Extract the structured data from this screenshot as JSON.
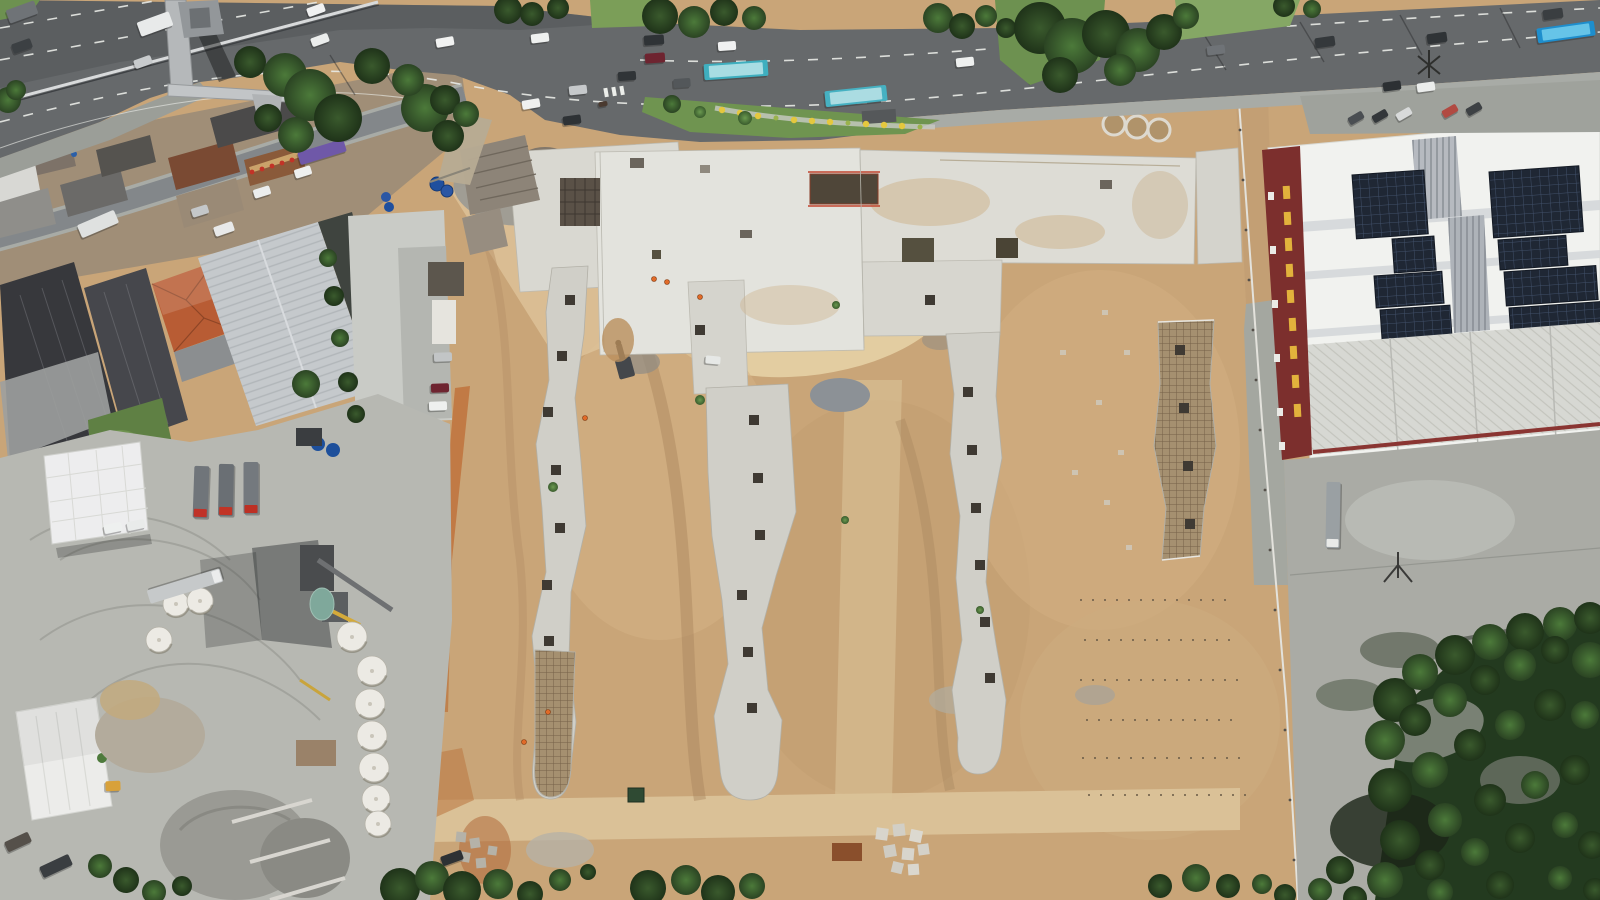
{
  "scene": {
    "type": "aerial-drone-photograph",
    "subjects": [
      "highway with traffic and buses",
      "pedestrian footbridge",
      "street with shops and vehicles",
      "industrial warehouses",
      "red tile roof house",
      "concrete batch plant yard with silo domes and trucks",
      "large earthworks construction site",
      "concrete foundation slabs and strip footings",
      "rebar mats",
      "warehouse with rooftop solar panels and red vertical sign",
      "dense trees",
      "grass median with yellow flowers"
    ]
  },
  "palette": {
    "sand": "#c9a578",
    "sand_light": "#e4cfa4",
    "sand_dark": "#a9875f",
    "asphalt": "#66696b",
    "asphalt_dark": "#4e5154",
    "lane_line": "#e9ebe7",
    "concrete_slab": "#d9d8d1",
    "concrete_bright": "#e3e3dd",
    "strip_concrete": "#d0cfc8",
    "rebar_tan": "#a59070",
    "yard_concrete": "#b7b8b2",
    "right_yard": "#aaaba5",
    "roof_white": "#f1f2ef",
    "roof_lower": "#d7d8d3",
    "sign_maroon": "#7c2f2d",
    "sign_yellow": "#e2b23c",
    "solar_dark": "#1f2734",
    "tile_roof": "#b85c34",
    "dark_roof": "#37383c",
    "light_roof": "#c5c9cc",
    "grass": "#6f9450",
    "tree_dark": "#22371c",
    "bus_teal": "#3fafbf",
    "bus_blue": "#1e8ecd",
    "truck_red": "#c03228",
    "dirt_orange": "#c0763f",
    "pond_teal": "#7fa89b",
    "shoulder": "#a8aba6"
  },
  "vehicles": [
    {
      "x": 155,
      "y": 24,
      "w": 15,
      "l": 34,
      "rot": 70,
      "color": "#e8eaea",
      "name": "box-truck"
    },
    {
      "x": 22,
      "y": 12,
      "w": 14,
      "l": 30,
      "rot": 70,
      "color": "#6f7377",
      "name": "truck"
    },
    {
      "x": 22,
      "y": 46,
      "w": 10,
      "l": 20,
      "rot": 70,
      "color": "#3c4043",
      "name": "car"
    },
    {
      "x": 143,
      "y": 62,
      "w": 9,
      "l": 18,
      "rot": 70,
      "color": "#c8cbcd",
      "name": "car"
    },
    {
      "x": 316,
      "y": 10,
      "w": 9,
      "l": 18,
      "rot": 70,
      "color": "#f0f1f1",
      "name": "car"
    },
    {
      "x": 320,
      "y": 40,
      "w": 9,
      "l": 18,
      "rot": 70,
      "color": "#ebedec",
      "name": "car"
    },
    {
      "x": 445,
      "y": 42,
      "w": 9,
      "l": 18,
      "rot": 80,
      "color": "#f1f2f1",
      "name": "car"
    },
    {
      "x": 540,
      "y": 38,
      "w": 9,
      "l": 18,
      "rot": 83,
      "color": "#eef0ef",
      "name": "car"
    },
    {
      "x": 654,
      "y": 40,
      "w": 10,
      "l": 20,
      "rot": 86,
      "color": "#2f3336",
      "name": "suv"
    },
    {
      "x": 655,
      "y": 58,
      "w": 10,
      "l": 20,
      "rot": 86,
      "color": "#6e2430",
      "name": "car"
    },
    {
      "x": 727,
      "y": 46,
      "w": 9,
      "l": 18,
      "rot": 86,
      "color": "#f0f1f1",
      "name": "car"
    },
    {
      "x": 627,
      "y": 76,
      "w": 9,
      "l": 18,
      "rot": 86,
      "color": "#303437",
      "name": "car"
    },
    {
      "x": 578,
      "y": 90,
      "w": 9,
      "l": 18,
      "rot": 84,
      "color": "#c6c9cb",
      "name": "car"
    },
    {
      "x": 531,
      "y": 104,
      "w": 9,
      "l": 18,
      "rot": 80,
      "color": "#eff0ef",
      "name": "car"
    },
    {
      "x": 572,
      "y": 120,
      "w": 9,
      "l": 18,
      "rot": 82,
      "color": "#2e3235",
      "name": "car"
    },
    {
      "x": 682,
      "y": 83,
      "w": 9,
      "l": 17,
      "rot": 86,
      "color": "#53575a",
      "name": "car"
    },
    {
      "x": 736,
      "y": 70,
      "w": 16,
      "l": 64,
      "rot": 86,
      "color": "#3fafbf",
      "roof": "#a8dde3",
      "name": "city-bus"
    },
    {
      "x": 856,
      "y": 96,
      "w": 16,
      "l": 62,
      "rot": 84,
      "color": "#46b1c2",
      "roof": "#abdce2",
      "name": "city-bus"
    },
    {
      "x": 603,
      "y": 104,
      "w": 5,
      "l": 9,
      "rot": 80,
      "color": "#4a3a30",
      "name": "motorcycle"
    },
    {
      "x": 965,
      "y": 62,
      "w": 9,
      "l": 18,
      "rot": 84,
      "color": "#eef0ef",
      "name": "car"
    },
    {
      "x": 1066,
      "y": 62,
      "w": 9,
      "l": 18,
      "rot": 84,
      "color": "#f0f1f0",
      "name": "car"
    },
    {
      "x": 1216,
      "y": 50,
      "w": 9,
      "l": 18,
      "rot": 83,
      "color": "#6f7377",
      "name": "car"
    },
    {
      "x": 1325,
      "y": 42,
      "w": 10,
      "l": 20,
      "rot": 82,
      "color": "#34383b",
      "name": "car"
    },
    {
      "x": 1437,
      "y": 38,
      "w": 10,
      "l": 20,
      "rot": 82,
      "color": "#2f3336",
      "name": "car"
    },
    {
      "x": 1553,
      "y": 14,
      "w": 10,
      "l": 20,
      "rot": 82,
      "color": "#3a3e41",
      "name": "car"
    },
    {
      "x": 1566,
      "y": 32,
      "w": 15,
      "l": 58,
      "rot": 82,
      "color": "#1e8ecd",
      "roof": "#66c4e8",
      "name": "city-bus"
    },
    {
      "x": 1392,
      "y": 86,
      "w": 9,
      "l": 18,
      "rot": 82,
      "color": "#2c3033",
      "name": "car"
    },
    {
      "x": 1426,
      "y": 87,
      "w": 9,
      "l": 18,
      "rot": 82,
      "color": "#ebedec",
      "name": "car"
    },
    {
      "x": 1356,
      "y": 118,
      "w": 8,
      "l": 16,
      "rot": 60,
      "color": "#4a4e52",
      "name": "parked-car"
    },
    {
      "x": 1380,
      "y": 116,
      "w": 8,
      "l": 16,
      "rot": 60,
      "color": "#33373a",
      "name": "parked-car"
    },
    {
      "x": 1404,
      "y": 114,
      "w": 8,
      "l": 16,
      "rot": 60,
      "color": "#d8dada",
      "name": "parked-car"
    },
    {
      "x": 1450,
      "y": 111,
      "w": 8,
      "l": 16,
      "rot": 60,
      "color": "#b14a42",
      "name": "parked-car"
    },
    {
      "x": 1474,
      "y": 109,
      "w": 8,
      "l": 16,
      "rot": 60,
      "color": "#3d4144",
      "name": "parked-car"
    },
    {
      "x": 322,
      "y": 152,
      "w": 13,
      "l": 48,
      "rot": 73,
      "color": "#6f58a8",
      "name": "purple-truck"
    },
    {
      "x": 303,
      "y": 172,
      "w": 9,
      "l": 17,
      "rot": 73,
      "color": "#eef0ef",
      "name": "car"
    },
    {
      "x": 262,
      "y": 192,
      "w": 9,
      "l": 17,
      "rot": 73,
      "color": "#ebeded",
      "name": "car"
    },
    {
      "x": 200,
      "y": 211,
      "w": 9,
      "l": 17,
      "rot": 73,
      "color": "#c4c7c9",
      "name": "car"
    },
    {
      "x": 224,
      "y": 229,
      "w": 10,
      "l": 20,
      "rot": 71,
      "color": "#e8e9e9",
      "name": "van"
    },
    {
      "x": 98,
      "y": 224,
      "w": 14,
      "l": 40,
      "rot": 67,
      "color": "#dfe1e0",
      "name": "box-truck"
    },
    {
      "x": 443,
      "y": 357,
      "w": 9,
      "l": 18,
      "rot": 88,
      "color": "#c2c5c6",
      "name": "parked-car"
    },
    {
      "x": 440,
      "y": 388,
      "w": 9,
      "l": 18,
      "rot": 88,
      "color": "#6e2430",
      "name": "parked-car"
    },
    {
      "x": 438,
      "y": 406,
      "w": 9,
      "l": 18,
      "rot": 88,
      "color": "#eef0ef",
      "name": "parked-car"
    },
    {
      "x": 452,
      "y": 858,
      "w": 10,
      "l": 22,
      "rot": 70,
      "color": "#2e3134",
      "name": "site-truck"
    },
    {
      "x": 713,
      "y": 360,
      "w": 8,
      "l": 15,
      "rot": 95,
      "color": "#e6e8e6",
      "name": "pickup"
    },
    {
      "x": 201,
      "y": 492,
      "w": 15,
      "l": 52,
      "rot": 2,
      "color": "#70757a",
      "cab": "#c03228",
      "name": "pump-truck"
    },
    {
      "x": 226,
      "y": 490,
      "w": 15,
      "l": 52,
      "rot": 1,
      "color": "#6a6f74",
      "cab": "#c23426",
      "name": "pump-truck"
    },
    {
      "x": 251,
      "y": 488,
      "w": 15,
      "l": 52,
      "rot": 0,
      "color": "#74797e",
      "cab": "#bd3024",
      "name": "pump-truck"
    },
    {
      "x": 185,
      "y": 586,
      "w": 14,
      "l": 76,
      "rot": -107,
      "color": "#c6c9ca",
      "cab": "#ebecec",
      "name": "tanker-truck"
    },
    {
      "x": 1333,
      "y": 515,
      "w": 14,
      "l": 66,
      "rot": 1,
      "color": "#9aa0a3",
      "cab": "#e9eae8",
      "name": "semi-truck"
    },
    {
      "x": 113,
      "y": 528,
      "w": 9,
      "l": 18,
      "rot": 78,
      "color": "#eef0ef",
      "name": "parked-car"
    },
    {
      "x": 136,
      "y": 525,
      "w": 9,
      "l": 18,
      "rot": 78,
      "color": "#e9ebea",
      "name": "parked-car"
    },
    {
      "x": 56,
      "y": 866,
      "w": 12,
      "l": 32,
      "rot": 65,
      "color": "#3a3e41",
      "name": "truck"
    },
    {
      "x": 18,
      "y": 842,
      "w": 11,
      "l": 26,
      "rot": 65,
      "color": "#55504a",
      "name": "truck"
    },
    {
      "x": 113,
      "y": 786,
      "w": 10,
      "l": 15,
      "rot": 88,
      "color": "#d8a13a",
      "name": "wheel-loader"
    }
  ],
  "tree_clusters": [
    [
      8,
      100,
      13,
      1
    ],
    [
      16,
      90,
      10,
      1
    ],
    [
      250,
      62,
      16,
      0
    ],
    [
      285,
      75,
      22,
      1
    ],
    [
      310,
      95,
      26,
      1
    ],
    [
      338,
      118,
      24,
      0
    ],
    [
      296,
      135,
      18,
      1
    ],
    [
      268,
      118,
      14,
      0
    ],
    [
      425,
      108,
      24,
      1
    ],
    [
      448,
      136,
      16,
      0
    ],
    [
      408,
      80,
      16,
      1
    ],
    [
      372,
      66,
      18,
      0
    ],
    [
      508,
      10,
      14,
      0
    ],
    [
      532,
      14,
      12,
      0
    ],
    [
      558,
      8,
      11,
      0
    ],
    [
      660,
      16,
      18,
      0
    ],
    [
      694,
      22,
      16,
      1
    ],
    [
      724,
      12,
      14,
      0
    ],
    [
      754,
      18,
      12,
      1
    ],
    [
      672,
      104,
      9,
      1
    ],
    [
      700,
      112,
      6,
      2
    ],
    [
      745,
      118,
      7,
      2
    ],
    [
      938,
      18,
      15,
      1
    ],
    [
      962,
      26,
      13,
      0
    ],
    [
      986,
      16,
      11,
      1
    ],
    [
      1006,
      28,
      10,
      0
    ],
    [
      1040,
      28,
      26,
      0
    ],
    [
      1072,
      46,
      28,
      1
    ],
    [
      1106,
      34,
      24,
      0
    ],
    [
      1138,
      50,
      22,
      1
    ],
    [
      1164,
      32,
      18,
      0
    ],
    [
      1186,
      16,
      13,
      1
    ],
    [
      1060,
      75,
      18,
      0
    ],
    [
      1120,
      70,
      16,
      1
    ],
    [
      1284,
      6,
      11,
      0
    ],
    [
      1312,
      9,
      9,
      1
    ],
    [
      328,
      258,
      9,
      1
    ],
    [
      334,
      296,
      10,
      0
    ],
    [
      340,
      338,
      9,
      1
    ],
    [
      348,
      382,
      10,
      0
    ],
    [
      306,
      384,
      14,
      1
    ],
    [
      356,
      414,
      9,
      0
    ],
    [
      445,
      100,
      15,
      0
    ],
    [
      466,
      114,
      13,
      1
    ],
    [
      100,
      866,
      12,
      1
    ],
    [
      126,
      880,
      13,
      0
    ],
    [
      154,
      892,
      12,
      1
    ],
    [
      182,
      886,
      10,
      0
    ],
    [
      400,
      888,
      20,
      0
    ],
    [
      432,
      878,
      17,
      1
    ],
    [
      462,
      890,
      19,
      0
    ],
    [
      498,
      884,
      15,
      1
    ],
    [
      530,
      894,
      13,
      0
    ],
    [
      560,
      880,
      11,
      1
    ],
    [
      588,
      872,
      8,
      0
    ],
    [
      648,
      888,
      18,
      0
    ],
    [
      686,
      880,
      15,
      1
    ],
    [
      718,
      892,
      17,
      0
    ],
    [
      752,
      886,
      13,
      1
    ],
    [
      1160,
      886,
      12,
      0
    ],
    [
      1196,
      878,
      14,
      1
    ],
    [
      1228,
      886,
      12,
      0
    ],
    [
      1262,
      884,
      10,
      1
    ],
    [
      1285,
      895,
      11,
      0
    ],
    [
      553,
      487,
      5,
      2
    ],
    [
      700,
      400,
      5,
      2
    ],
    [
      845,
      520,
      4,
      2
    ],
    [
      980,
      610,
      4,
      2
    ],
    [
      836,
      305,
      4,
      2
    ],
    [
      1395,
      700,
      22,
      0
    ],
    [
      1420,
      672,
      18,
      1
    ],
    [
      1455,
      655,
      20,
      0
    ],
    [
      1490,
      642,
      18,
      1
    ],
    [
      1525,
      632,
      19,
      0
    ],
    [
      1560,
      624,
      17,
      1
    ],
    [
      1590,
      618,
      16,
      0
    ],
    [
      1385,
      740,
      20,
      1
    ],
    [
      1415,
      720,
      16,
      0
    ],
    [
      1450,
      700,
      17,
      1
    ],
    [
      1485,
      680,
      15,
      0
    ],
    [
      1520,
      665,
      16,
      1
    ],
    [
      1555,
      650,
      14,
      0
    ],
    [
      1590,
      660,
      18,
      1
    ],
    [
      1390,
      790,
      22,
      0
    ],
    [
      1430,
      770,
      18,
      1
    ],
    [
      1470,
      745,
      16,
      0
    ],
    [
      1510,
      725,
      15,
      1
    ],
    [
      1550,
      705,
      16,
      0
    ],
    [
      1585,
      715,
      14,
      1
    ],
    [
      1400,
      840,
      20,
      0
    ],
    [
      1445,
      820,
      17,
      1
    ],
    [
      1490,
      800,
      16,
      0
    ],
    [
      1535,
      785,
      14,
      1
    ],
    [
      1575,
      770,
      15,
      0
    ],
    [
      1385,
      880,
      18,
      1
    ],
    [
      1430,
      865,
      15,
      0
    ],
    [
      1475,
      852,
      14,
      1
    ],
    [
      1520,
      838,
      15,
      0
    ],
    [
      1565,
      825,
      13,
      1
    ],
    [
      1592,
      845,
      14,
      0
    ],
    [
      1440,
      892,
      13,
      1
    ],
    [
      1500,
      885,
      14,
      0
    ],
    [
      1560,
      878,
      12,
      1
    ],
    [
      1595,
      890,
      12,
      0
    ],
    [
      1340,
      870,
      14,
      0
    ],
    [
      1320,
      890,
      12,
      1
    ],
    [
      1355,
      898,
      12,
      0
    ]
  ],
  "silo_domes": [
    [
      176,
      604,
      13
    ],
    [
      200,
      601,
      13
    ],
    [
      159,
      640,
      13
    ],
    [
      352,
      637,
      15
    ],
    [
      372,
      671,
      15
    ],
    [
      370,
      704,
      15
    ],
    [
      372,
      736,
      15
    ],
    [
      374,
      768,
      15
    ],
    [
      376,
      799,
      14
    ],
    [
      378,
      824,
      13
    ]
  ],
  "solar_arrays": [
    [
      1352,
      175,
      72,
      64
    ],
    [
      1392,
      239,
      42,
      34
    ],
    [
      1374,
      276,
      68,
      32
    ],
    [
      1380,
      310,
      70,
      56
    ],
    [
      1489,
      172,
      90,
      66
    ],
    [
      1498,
      240,
      68,
      30
    ],
    [
      1504,
      272,
      92,
      34
    ],
    [
      1509,
      308,
      92,
      44
    ]
  ],
  "concrete_rings": [
    [
      1114,
      124
    ],
    [
      1137,
      127
    ],
    [
      1159,
      130
    ]
  ],
  "footing_pads": [
    [
      570,
      300
    ],
    [
      562,
      356
    ],
    [
      548,
      412
    ],
    [
      556,
      470
    ],
    [
      560,
      528
    ],
    [
      547,
      585
    ],
    [
      549,
      641
    ],
    [
      754,
      420
    ],
    [
      758,
      478
    ],
    [
      760,
      535
    ],
    [
      742,
      595
    ],
    [
      748,
      652
    ],
    [
      752,
      708
    ],
    [
      968,
      392
    ],
    [
      972,
      450
    ],
    [
      976,
      508
    ],
    [
      980,
      565
    ],
    [
      985,
      622
    ],
    [
      990,
      678
    ],
    [
      1180,
      350
    ],
    [
      1184,
      408
    ],
    [
      1188,
      466
    ],
    [
      1190,
      524
    ],
    [
      700,
      330
    ],
    [
      930,
      300
    ]
  ],
  "flower_dots": [
    [
      722,
      110
    ],
    [
      740,
      113
    ],
    [
      758,
      116
    ],
    [
      776,
      118
    ],
    [
      794,
      120
    ],
    [
      812,
      121
    ],
    [
      830,
      122
    ],
    [
      848,
      123
    ],
    [
      866,
      124
    ],
    [
      884,
      125
    ],
    [
      902,
      126
    ],
    [
      920,
      127
    ]
  ],
  "workers": [
    [
      654,
      279
    ],
    [
      667,
      282
    ],
    [
      700,
      297
    ],
    [
      585,
      418
    ],
    [
      548,
      712
    ],
    [
      524,
      742
    ]
  ]
}
